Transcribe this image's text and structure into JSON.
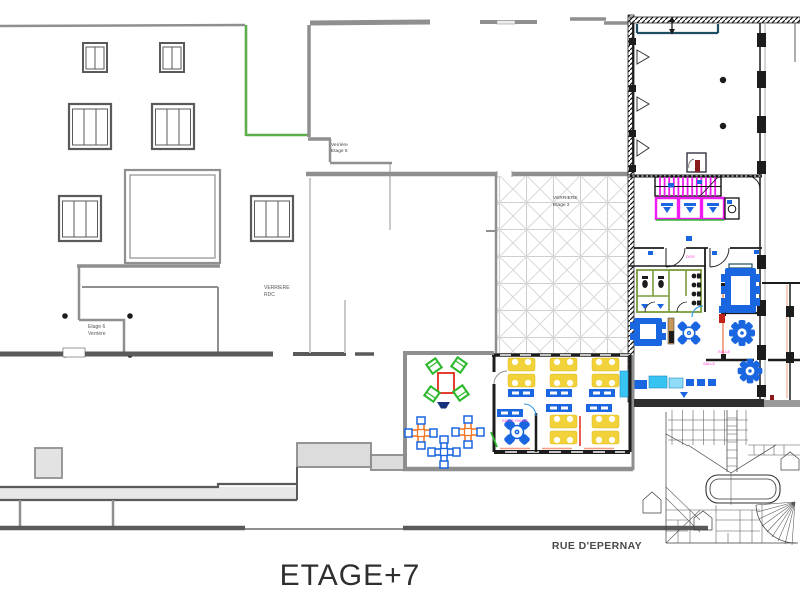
{
  "drawing": {
    "floor_title": "ETAGE+7",
    "street_label": "RUE D'EPERNAY"
  },
  "annotations": {
    "verriere_etage5": {
      "line1": "Verrière",
      "line2": "Etage 5"
    },
    "verriere_rdc": {
      "line1": "VERRIERE",
      "line2": "RDC"
    },
    "etage6_verriere": {
      "line1": "Etage 6",
      "line2": "Verrière"
    },
    "verriere_etage2": {
      "line1": "VERRIERE",
      "line2": "Etage 2"
    }
  },
  "room_tags": {
    "office_break": "SALLE PAUSE",
    "meeting_a": "SALLE",
    "meeting_b": "SALLE",
    "dgs": "DGS"
  },
  "colors": {
    "paper": "#ffffff",
    "wall-light": "#c9c9c9",
    "wall-gray": "#8f8f8f",
    "wall-dark": "#5a5a5a",
    "wall-black": "#1c1c1c",
    "hatch-gray": "#cfcfcf",
    "accent-green": "#5fae4e",
    "sanitary-green": "#7a9a3a",
    "furniture-green": "#2db82d",
    "furniture-blue": "#1a66e0",
    "furniture-cyan": "#38c4f2",
    "cyan-light": "#8fdcf8",
    "furniture-yellow": "#f2d23a",
    "furniture-orange": "#f07a28",
    "furniture-red": "#e02818",
    "magenta": "#f21af2",
    "navy": "#16327d",
    "teal": "#1f4e63",
    "salmon": "#f0a080",
    "tan": "#c89858",
    "label-pink": "#ff38d8",
    "ink": "#2e2e2e",
    "maroon": "#8b1a1a"
  }
}
